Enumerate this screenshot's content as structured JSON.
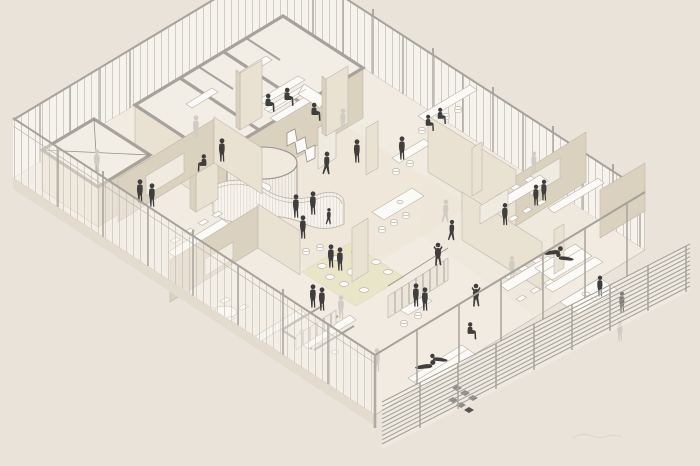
{
  "scene": {
    "type": "axonometric cutaway floor plan of an open office interior",
    "figures_dark_count": 32,
    "figures_light_count": 9
  },
  "palette": {
    "background": "#eae3da",
    "floor": "#f1ebe1",
    "floor_tint": "#ece4d6",
    "block_floor": "#f3eee5",
    "wall_lit": "#e9e1d2",
    "wall_shade": "#dbd1bf",
    "wall_deep": "#cfc3ad",
    "cap_gray": "#a7a29b",
    "line": "#96918a",
    "line_light": "#bcb7ae",
    "glass": "#f8f5ef",
    "glass_mullion": "#b9b3a9",
    "white": "#fbfaf6",
    "rug": "#e9e5c8",
    "louver": "#a29d95",
    "figure_dark": "#3f3e3c",
    "figure_light": "#d0cbc3",
    "plant_dark": "#55534f",
    "plinth": "#e3dbce",
    "board": "#f0ebe1",
    "watermark": "#d9d1c6"
  }
}
